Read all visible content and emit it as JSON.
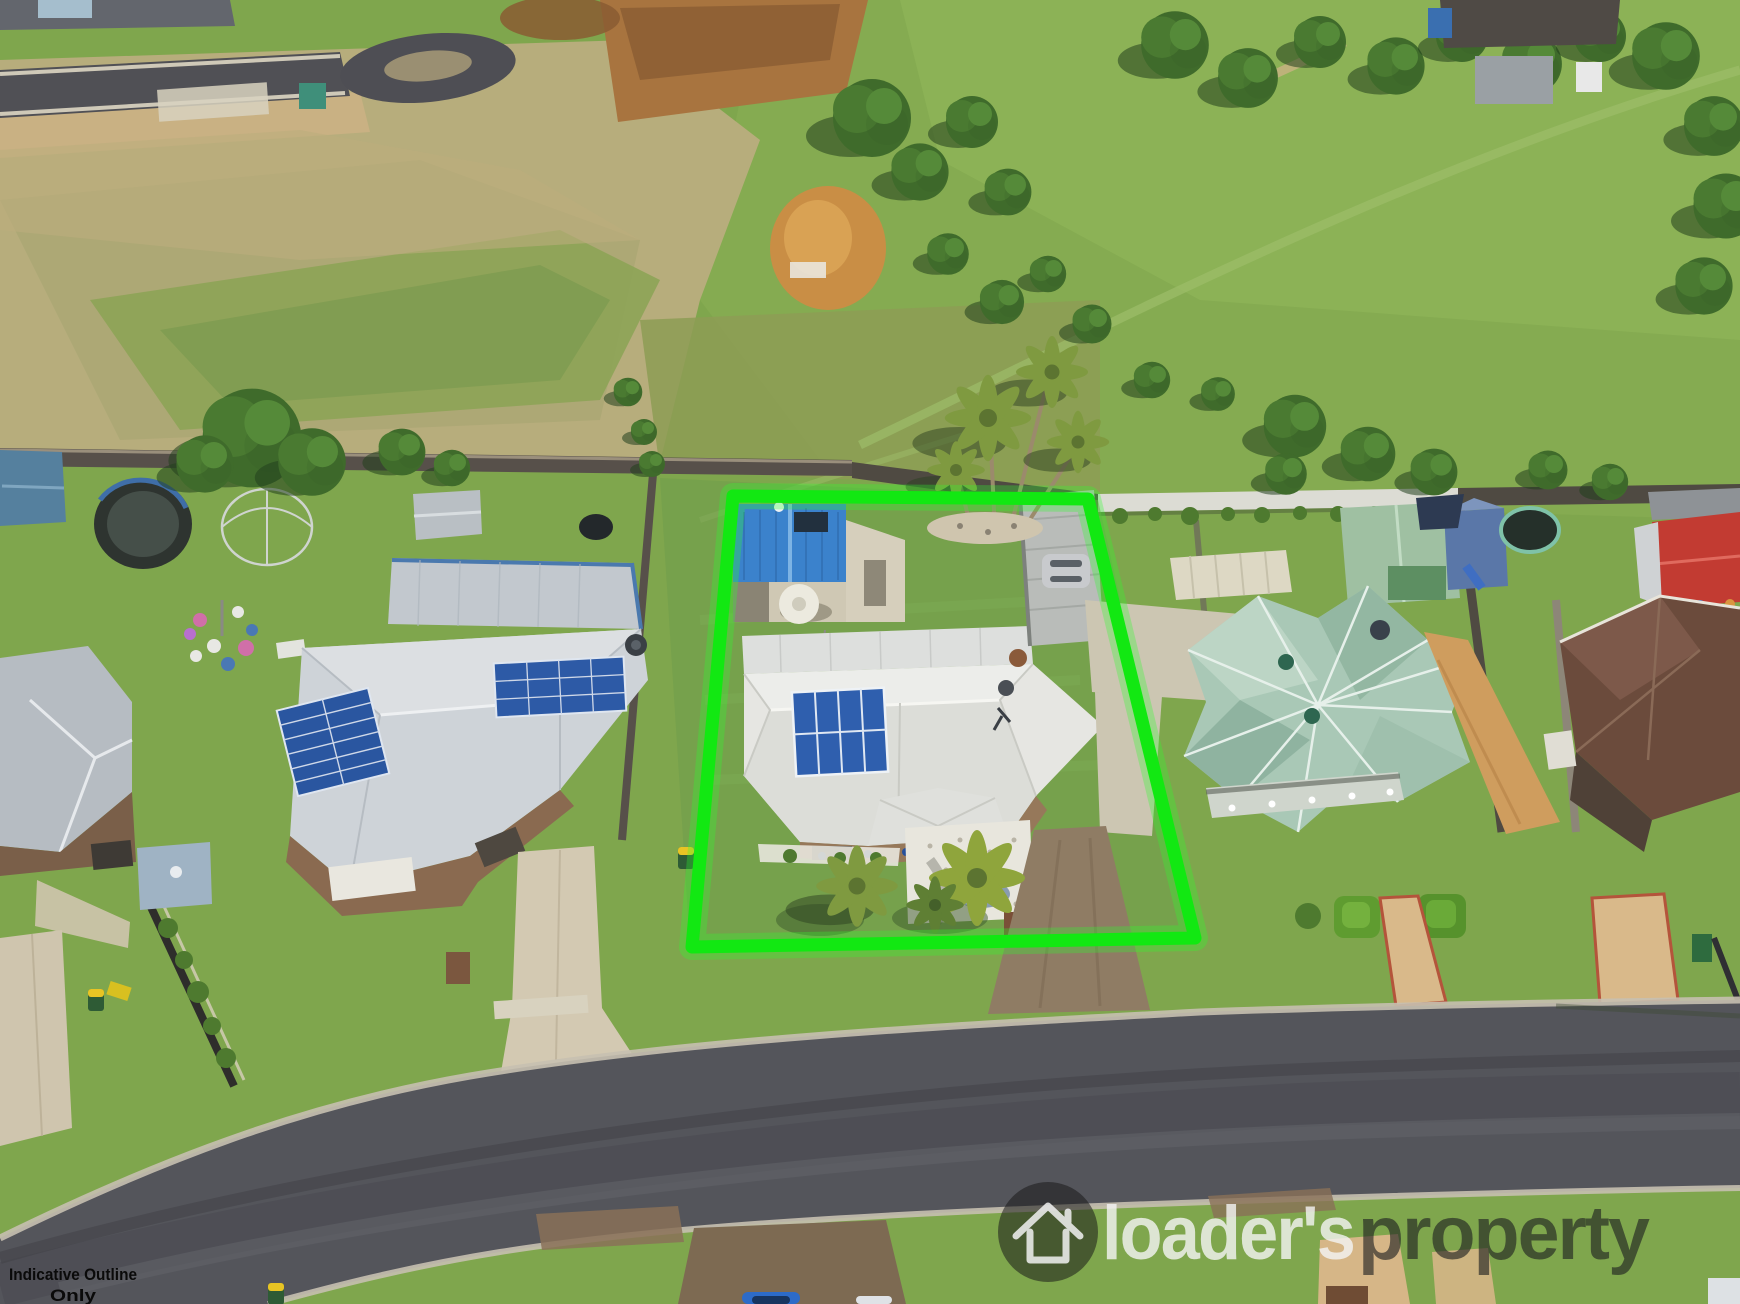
{
  "annotations": {
    "indicative_line1": "Indicative Outline",
    "indicative_line2": "Only"
  },
  "watermark": {
    "brand_left": "loader's",
    "brand_right": "property",
    "icon": "home-icon"
  },
  "property_outline": {
    "points": "733,496 1088,499 1195,938 692,947",
    "color": "#12e812"
  },
  "colors": {
    "outline_green": "#12e812",
    "watermark_white": "#f5f5f5",
    "watermark_dark": "#1d1f20",
    "annotation_black": "#0a0a0a",
    "road_asphalt": "#54555b",
    "kerb_concrete": "#c6c0b0",
    "grass_green": "#7fa64d",
    "dry_grass": "#b7ad7c",
    "main_roof_white": "#e6e6e2",
    "left_roof_grey": "#ced3d8",
    "right_roof_seafoam": "#a9c8b6",
    "shed_roof_blue": "#3b82cc",
    "shed_roof_red": "#c23b32",
    "solar_panel_blue": "#2f5fae",
    "driveway_tan": "#cfc5ae"
  }
}
